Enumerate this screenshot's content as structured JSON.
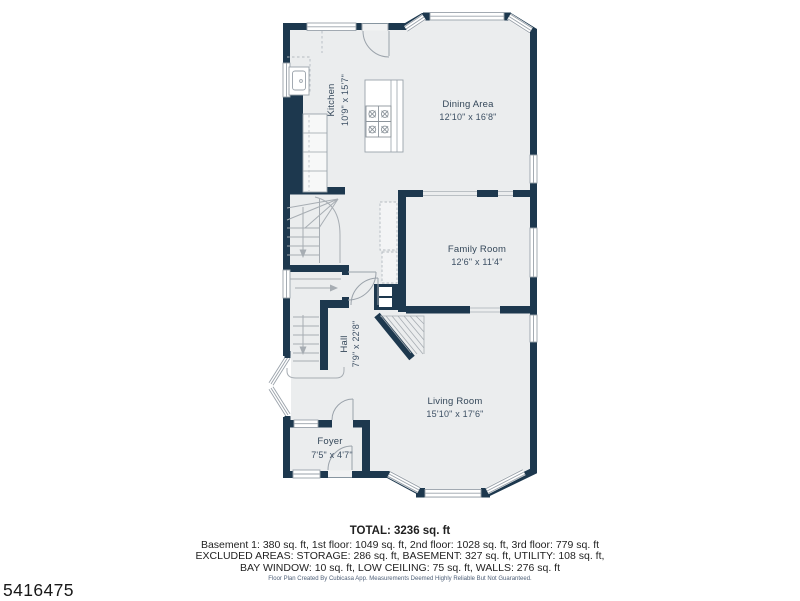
{
  "page": {
    "photo_id": "5416475",
    "background": "#ffffff"
  },
  "plan": {
    "colors": {
      "wall": "#1d384e",
      "floor": "#ebedee",
      "detail_line": "#a7adb3",
      "label_text": "#344759"
    },
    "rooms": [
      {
        "name": "Kitchen",
        "dims": "10'9\" x 15'7\"",
        "orientation": "vertical"
      },
      {
        "name": "Dining Area",
        "dims": "12'10\" x 16'8\"",
        "orientation": "horizontal"
      },
      {
        "name": "Family Room",
        "dims": "12'6\" x 11'4\"",
        "orientation": "horizontal"
      },
      {
        "name": "Hall",
        "dims": "7'9\" x 22'8\"",
        "orientation": "vertical"
      },
      {
        "name": "Living Room",
        "dims": "15'10\" x 17'6\"",
        "orientation": "horizontal"
      },
      {
        "name": "Foyer",
        "dims": "7'5\" x 4'7\"",
        "orientation": "horizontal"
      }
    ]
  },
  "summary": {
    "total": "TOTAL: 3236 sq. ft",
    "floors": "Basement 1: 380 sq. ft, 1st floor: 1049 sq. ft, 2nd floor: 1028 sq. ft, 3rd floor: 779 sq. ft",
    "excluded_line1": "EXCLUDED AREAS: STORAGE: 286 sq. ft, BASEMENT: 327 sq. ft, UTILITY: 108 sq. ft,",
    "excluded_line2": "BAY WINDOW: 10 sq. ft, LOW CEILING: 75 sq. ft, WALLS: 276 sq. ft",
    "disclaimer": "Floor Plan Created By Cubicasa App. Measurements Deemed Highly Reliable But Not Guaranteed."
  }
}
